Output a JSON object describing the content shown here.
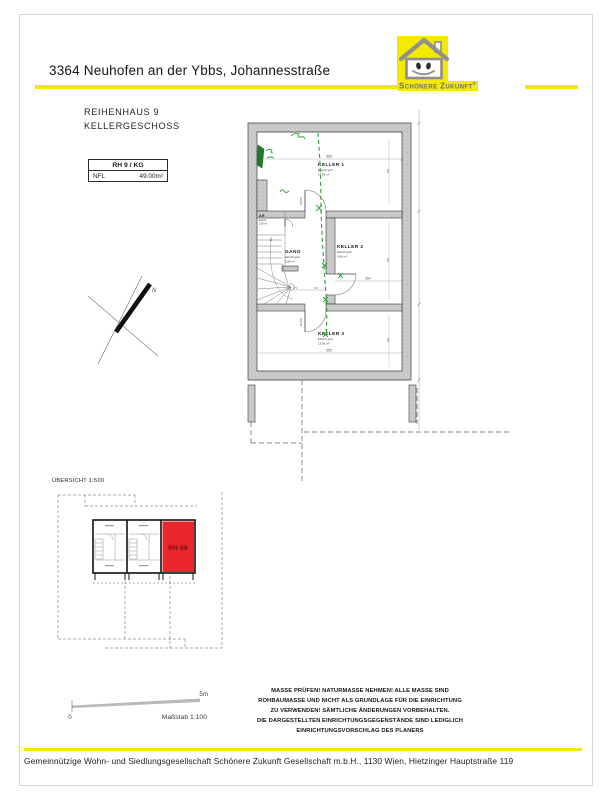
{
  "header": {
    "title": "3364 Neuhofen an der Ybbs, Johannesstraße",
    "accent_color": "#f4ea00"
  },
  "logo": {
    "wordmark": "Schönere Zukunft",
    "registered": "®",
    "icon": "smiling-house"
  },
  "plan_header": {
    "line1": "REIHENHAUS 9",
    "line2": "KELLERGESCHOSS"
  },
  "info_box": {
    "title": "RH 9 / KG",
    "nfl_label": "NFL",
    "nfl_value": "49.00m²"
  },
  "floorplan": {
    "rooms": {
      "keller1": {
        "name": "KELLER 1",
        "floor": "Estrich geb.",
        "area": "17.93 m²"
      },
      "keller2": {
        "name": "KELLER 2",
        "floor": "Estrich geb.",
        "area": "9.46 m²"
      },
      "keller3": {
        "name": "KELLER 3",
        "floor": "Estrich geb.",
        "area": "13.05 m²"
      },
      "gang": {
        "name": "GANG",
        "floor": "Estrich geb.",
        "area": "5.96 m²"
      },
      "ar": {
        "name": "AR",
        "floor": "Estrich",
        "area": "2.60 m²"
      }
    },
    "dims": {
      "keller1_width": "555",
      "keller2_width": "364",
      "keller3_width": "555",
      "gang_width": "170",
      "gang_door": "90",
      "keller1_depth": "255",
      "keller2_depth": "285",
      "keller3_depth": "200",
      "door_size": "80/205"
    },
    "north_label": "N",
    "annotation_color": "#2f9e38"
  },
  "overview": {
    "title": "ÜBERSICHT 1:500",
    "unit_label": "RH 09",
    "unit_color": "#e9262b"
  },
  "scale": {
    "zero": "0",
    "max": "5m",
    "label": "Maßstab 1:100"
  },
  "disclaimer": {
    "lines": [
      "MASSE PRÜFEN! NATURMASSE NEHMEN! ALLE MASSE SIND",
      "ROHBAUMASSE UND NICHT ALS GRUNDLAGE FÜR DIE EINRICHTUNG",
      "ZU VERWENDEN! SÄMTLICHE ÄNDERUNGEN VORBEHALTEN.",
      "DIE DARGESTELLTEN EINRICHTUNGSGEGENSTÄNDE SIND LEDIGLICH",
      "EINRICHTUNGSVORSCHLAG DES PLANERS"
    ]
  },
  "footer": {
    "text": "Gemeinnützige Wohn- und Siedlungsgesellschaft Schönere Zukunft Gesellschaft m.b.H., 1130 Wien, Hietzinger Hauptstraße 119"
  }
}
